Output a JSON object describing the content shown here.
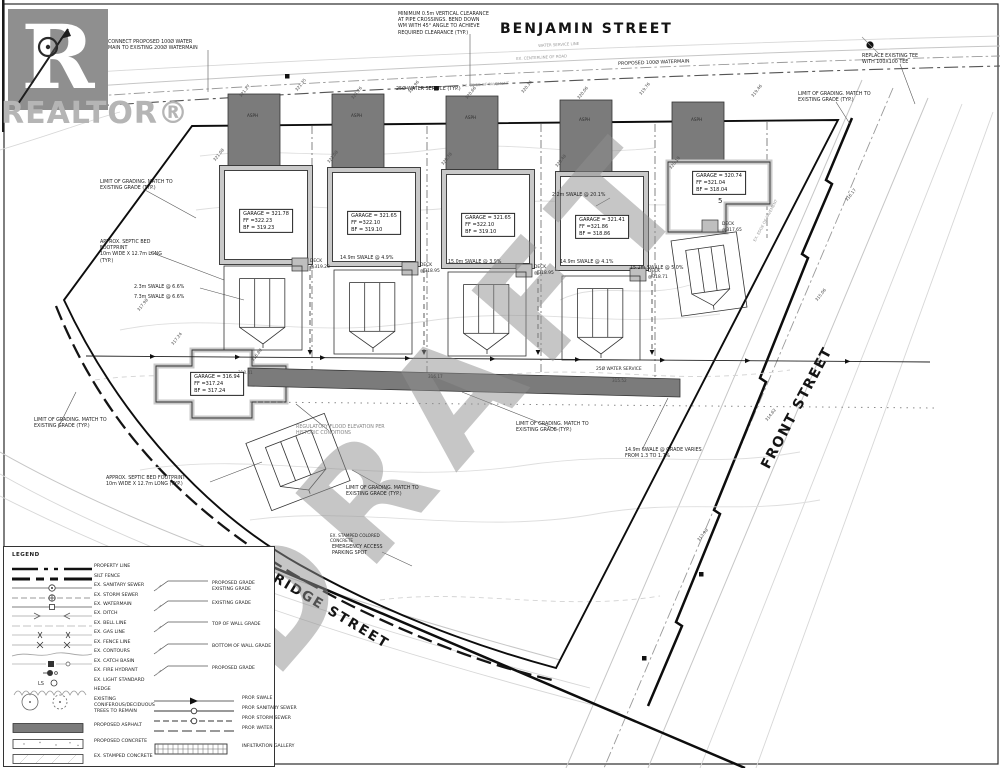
{
  "branding": {
    "logo_letter": "R",
    "wordmark": "REALTOR®"
  },
  "watermarks": {
    "draft": "DRAFT",
    "licensed": "Licensed to CAOR"
  },
  "streets": {
    "top": "BENJAMIN STREET",
    "right": "FRONT STREET",
    "bottom": "BRIDGE STREET"
  },
  "plan": {
    "houses": [
      {
        "id": "1",
        "garage": "GARAGE = 321.78",
        "ff": "FF =322.23",
        "bf": "BF = 319.23",
        "x": 266,
        "y": 221,
        "deck": "DECK\n@319.23",
        "deck_x": 310,
        "deck_y": 259
      },
      {
        "id": "2",
        "garage": "GARAGE = 321.65",
        "ff": "FF =322.10",
        "bf": "BF = 319.10",
        "x": 374,
        "y": 223,
        "deck": "DECK\n@318.95",
        "deck_x": 420,
        "deck_y": 263
      },
      {
        "id": "3",
        "garage": "GARAGE = 321.65",
        "ff": "FF =322.10",
        "bf": "BF = 319.10",
        "x": 488,
        "y": 225,
        "deck": "DECK\n@318.95",
        "deck_x": 534,
        "deck_y": 265
      },
      {
        "id": "4",
        "garage": "GARAGE = 321.41",
        "ff": "FF =321.86",
        "bf": "BF = 318.86",
        "x": 602,
        "y": 227,
        "deck": "DECK\n@318.71",
        "deck_x": 648,
        "deck_y": 269
      },
      {
        "id": "5",
        "garage": "GARAGE = 320.74",
        "ff": "FF =321.04",
        "bf": "BF = 318.04",
        "x": 719,
        "y": 183,
        "deck": "DECK\n@317.65",
        "deck_x": 722,
        "deck_y": 222,
        "num": "5",
        "num_x": 718,
        "num_y": 197
      },
      {
        "id": "6",
        "garage": "GARAGE = 316.94",
        "ff": "FF =317.24",
        "bf": "BF = 317.24",
        "x": 217,
        "y": 384
      }
    ],
    "annotations": [
      {
        "n": "note-vertical-clearance",
        "t": "MINIMUM 0.5m VERTICAL CLEARANCE\nAT PIPE CROSSINGS. BEND DOWN\nWM WITH 45° ANGLE TO ACHIEVE\nREQUIRED CLEARANCE (TYP.)",
        "x": 398,
        "y": 12
      },
      {
        "n": "note-connect-watermain",
        "t": "CONNECT PROPOSED 100Ø WATER\nMAIN TO EXISTING 200Ø WATERMAIN",
        "x": 108,
        "y": 40
      },
      {
        "n": "note-water-service-typ",
        "t": "25Ø WATER SERVICE (TYP.)",
        "x": 396,
        "y": 87
      },
      {
        "n": "note-proposed-watermain",
        "t": "PROPOSED 100Ø WATERMAIN",
        "x": 618,
        "y": 62,
        "r": -2
      },
      {
        "n": "note-replace-tee",
        "t": "REPLACE EXISTING TEE\nWITH 100X100 TEE",
        "x": 862,
        "y": 54
      },
      {
        "n": "note-limit-grading-1",
        "t": "LIMIT OF GRADING. MATCH TO\nEXISTING GRADE (TYP.)",
        "x": 100,
        "y": 180
      },
      {
        "n": "note-limit-grading-2",
        "t": "LIMIT OF GRADING. MATCH TO\nEXISTING GRADE (TYP.)",
        "x": 798,
        "y": 92
      },
      {
        "n": "note-limit-grading-3",
        "t": "LIMIT OF GRADING. MATCH TO\nEXISTING GRADE (TYP.)",
        "x": 516,
        "y": 422
      },
      {
        "n": "note-limit-grading-4",
        "t": "LIMIT OF GRADING. MATCH TO\nEXISTING GRADE (TYP.)",
        "x": 34,
        "y": 418
      },
      {
        "n": "note-limit-grading-5",
        "t": "LIMIT OF GRADING. MATCH TO\nEXISTING GRADE (TYP.)",
        "x": 346,
        "y": 486
      },
      {
        "n": "note-septic-bed-1",
        "t": "APPROX. SEPTIC BED\nFOOTPRINT\n10m WIDE X 12.7m LONG\n(TYP.)",
        "x": 100,
        "y": 240
      },
      {
        "n": "note-septic-bed-2",
        "t": "APPROX. SEPTIC BED FOOTPRINT\n10m WIDE X 12.7m LONG (TYP.)",
        "x": 106,
        "y": 476
      },
      {
        "n": "note-swale-a",
        "t": "2.3m SWALE @ 6.6%",
        "x": 134,
        "y": 285
      },
      {
        "n": "note-swale-b",
        "t": "7.3m SWALE @ 6.6%",
        "x": 134,
        "y": 295
      },
      {
        "n": "note-swale-1",
        "t": "14.9m SWALE @ 4.9%",
        "x": 340,
        "y": 256
      },
      {
        "n": "note-swale-2",
        "t": "15.0m SWALE @ 3.9%",
        "x": 448,
        "y": 260
      },
      {
        "n": "note-swale-3",
        "t": "14.9m SWALE @ 4.1%",
        "x": 560,
        "y": 260
      },
      {
        "n": "note-swale-4",
        "t": "15.2m SWALE @ 5.0%",
        "x": 630,
        "y": 266
      },
      {
        "n": "note-swale-5",
        "t": "2.2m SWALE @ 20.1%",
        "x": 552,
        "y": 193
      },
      {
        "n": "note-swale-varies",
        "t": "14.9m SWALE @ GRADE VARIES\nFROM 1.3 TO 1.7%",
        "x": 625,
        "y": 448
      },
      {
        "n": "note-regulatory-flood",
        "t": "REGULATORY FLOOD ELEVATION PER\nHISTORIC CONDITIONS",
        "x": 296,
        "y": 425,
        "c": "#858585"
      },
      {
        "n": "note-stamped-concrete",
        "t": "EX. STAMPED COLORED\nCONCRETE",
        "x": 330,
        "y": 533,
        "s": 4.2
      },
      {
        "n": "note-emergency-access",
        "t": "EMERGENCY ACCESS\nPARKING SPOT",
        "x": 332,
        "y": 545
      },
      {
        "n": "label-water-service-strip",
        "t": "25Ø WATER SERVICE",
        "x": 596,
        "y": 367,
        "s": 4.4
      },
      {
        "n": "label-asph-1",
        "t": "ASPH",
        "x": 247,
        "y": 113,
        "s": 4.2,
        "c": "#2f2f2f"
      },
      {
        "n": "label-asph-2",
        "t": "ASPH",
        "x": 351,
        "y": 113,
        "s": 4.2,
        "c": "#2f2f2f"
      },
      {
        "n": "label-asph-3",
        "t": "ASPH",
        "x": 465,
        "y": 115,
        "s": 4.2,
        "c": "#2f2f2f"
      },
      {
        "n": "label-asph-4",
        "t": "ASPH",
        "x": 579,
        "y": 117,
        "s": 4.2,
        "c": "#2f2f2f"
      },
      {
        "n": "label-asph-5",
        "t": "ASPH",
        "x": 691,
        "y": 117,
        "s": 4.2,
        "c": "#2f2f2f"
      },
      {
        "n": "label-centerline-road",
        "t": "EX. CENTERLINE OF ROAD",
        "x": 516,
        "y": 56,
        "s": 3.9,
        "c": "#9a9a9a",
        "r": -3
      },
      {
        "n": "label-edge-pavement",
        "t": "EX. EDGE OF PAVEMENT",
        "x": 462,
        "y": 83,
        "s": 3.9,
        "c": "#9a9a9a",
        "r": -3
      },
      {
        "n": "label-water-service-line",
        "t": "WATER SERVICE LINE",
        "x": 538,
        "y": 43,
        "s": 3.9,
        "c": "#9a9a9a",
        "r": -3
      },
      {
        "n": "label-edge-pavement-front",
        "t": "EX. EDGE OF PAVEMENT",
        "x": 752,
        "y": 240,
        "s": 3.9,
        "c": "#9a9a9a",
        "r": -62
      }
    ],
    "spot_elevations": [
      {
        "v": "321.27",
        "x": 240,
        "y": 94
      },
      {
        "v": "321.35",
        "x": 296,
        "y": 88
      },
      {
        "v": "321.26",
        "x": 352,
        "y": 96
      },
      {
        "v": "320.96",
        "x": 409,
        "y": 90
      },
      {
        "v": "320.66",
        "x": 466,
        "y": 96
      },
      {
        "v": "320.36",
        "x": 522,
        "y": 90
      },
      {
        "v": "320.06",
        "x": 578,
        "y": 96
      },
      {
        "v": "319.76",
        "x": 640,
        "y": 92
      },
      {
        "v": "319.46",
        "x": 752,
        "y": 94
      },
      {
        "v": "321.08",
        "x": 214,
        "y": 158
      },
      {
        "v": "321.08",
        "x": 328,
        "y": 160
      },
      {
        "v": "320.78",
        "x": 442,
        "y": 162
      },
      {
        "v": "320.48",
        "x": 556,
        "y": 164
      },
      {
        "v": "320.18",
        "x": 670,
        "y": 166
      },
      {
        "v": "317.98",
        "x": 138,
        "y": 308
      },
      {
        "v": "317.24",
        "x": 172,
        "y": 342
      },
      {
        "v": "316.80",
        "x": 252,
        "y": 358
      },
      {
        "v": "316.17",
        "x": 846,
        "y": 198
      },
      {
        "v": "315.06",
        "x": 816,
        "y": 298
      },
      {
        "v": "314.62",
        "x": 766,
        "y": 418
      },
      {
        "v": "313.98",
        "x": 698,
        "y": 538
      },
      {
        "v": "318.41",
        "x": 238,
        "y": 370,
        "r": 0
      },
      {
        "v": "316.17",
        "x": 428,
        "y": 374,
        "r": 0
      },
      {
        "v": "315.52",
        "x": 612,
        "y": 378,
        "r": 0
      }
    ],
    "legend": {
      "title": "LEGEND",
      "items": [
        {
          "sym": "property",
          "label": "PROPERTY LINE"
        },
        {
          "sym": "silt",
          "label": "SILT FENCE"
        },
        {
          "sym": "sansew",
          "label": "EX. SANITARY SEWER"
        },
        {
          "sym": "storm",
          "label": "EX. STORM SEWER"
        },
        {
          "sym": "wm",
          "label": "EX. WATERMAIN"
        },
        {
          "sym": "ditch",
          "label": "EX. DITCH"
        },
        {
          "sym": "bell",
          "label": "EX. BELL LINE"
        },
        {
          "sym": "gas",
          "label": "EX. GAS LINE"
        },
        {
          "sym": "fence",
          "label": "EX. FENCE LINE"
        },
        {
          "sym": "contours",
          "label": "EX. CONTOURS"
        },
        {
          "sym": "cb",
          "label": "EX. CATCH BASIN"
        },
        {
          "sym": "hyd",
          "label": "EX. FIRE HYDRANT"
        },
        {
          "sym": "ls",
          "label": "EX. LIGHT STANDARD"
        },
        {
          "sym": "hedge",
          "label": "HEDGE"
        },
        {
          "sym": "trees",
          "label": "EXISTING\nCONIFEROUS/DECIDUOUS\nTREES TO REMAIN"
        },
        {
          "sym": "asphalt",
          "label": "PROPOSED ASPHALT"
        },
        {
          "sym": "concrete",
          "label": "PROPOSED CONCRETE"
        },
        {
          "sym": "stamped",
          "label": "EX. STAMPED CONCRETE"
        }
      ],
      "grade_callouts": [
        "PROPOSED GRADE\nEXISTING GRADE",
        "EXISTING GRADE",
        "TOP OF WALL GRADE",
        "BOTTOM OF WALL GRADE",
        "PROPOSED GRADE"
      ],
      "proposed_items": [
        {
          "sym": "pswale",
          "label": "PROP. SWALE"
        },
        {
          "sym": "psan",
          "label": "PROP. SANITARY SEWER"
        },
        {
          "sym": "pstorm",
          "label": "PROP. STORM SEWER"
        },
        {
          "sym": "pwater",
          "label": "PROP. WATER"
        },
        {
          "sym": "gallery",
          "label": "INFILTRATION GALLERY"
        }
      ]
    }
  }
}
